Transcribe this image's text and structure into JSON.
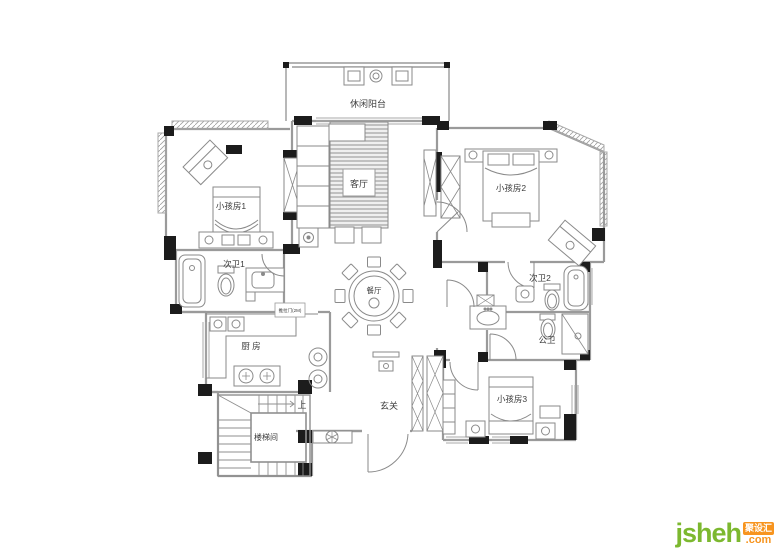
{
  "palette": {
    "wall": "#9a9a9a",
    "column": "#1c1c1c",
    "furniture": "#8a8a8a",
    "label_text": "#3c3c3c",
    "logo_green": "#7cb82f",
    "logo_orange": "#f7941e"
  },
  "rooms": {
    "balcony": {
      "label": "休闲阳台"
    },
    "living": {
      "label": "客厅"
    },
    "kid1": {
      "label": "小孩房1"
    },
    "bath1": {
      "label": "次卫1"
    },
    "kitchen": {
      "label": "厨 房"
    },
    "stairwell": {
      "label": "楼梯间"
    },
    "up": {
      "label": "上"
    },
    "foyer": {
      "label": "玄关"
    },
    "dining": {
      "label": "餐厅"
    },
    "kid2": {
      "label": "小孩房2"
    },
    "bath2": {
      "label": "次卫2"
    },
    "pubbath": {
      "label": "公卫"
    },
    "kid3": {
      "label": "小孩房3"
    }
  },
  "annotations": {
    "kitchen_door_note": "推拉门(2M)"
  },
  "logo": {
    "name": "jsheh",
    "badge": "聚设汇",
    "suffix": ".com"
  }
}
